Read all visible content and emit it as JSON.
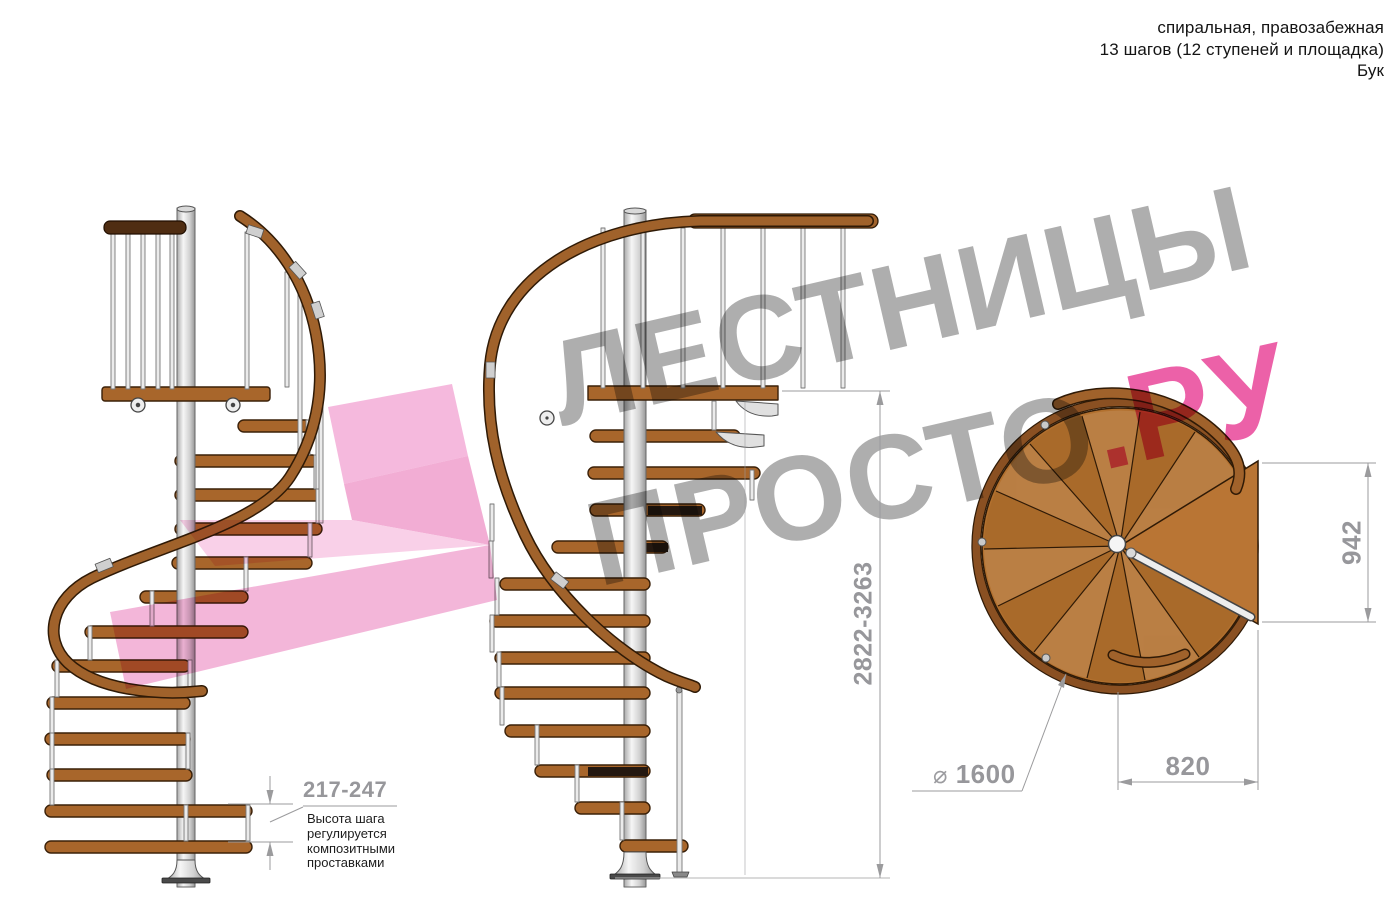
{
  "header": {
    "line1": "спиральная, правозабежная",
    "line2": "13 шагов (12 ступеней и площадка)",
    "line3": "Бук"
  },
  "watermark": {
    "line1": "ЛЕСТНИЦЫ",
    "line2_gray": "ПРОСТО",
    "line2_pink": ".РУ"
  },
  "dimensions": {
    "total_height": "2822-3263",
    "landing_length": "942",
    "landing_width": "820",
    "diameter_symbol": "⌀",
    "diameter_value": "1600",
    "step_height": "217-247"
  },
  "note": {
    "line1": "Высота шага",
    "line2": "регулируется",
    "line3": "композитными",
    "line4": "проставками"
  },
  "colors": {
    "wood": "#a0622b",
    "wood_dark": "#4f2d12",
    "steel": "#e8e8e8",
    "dimension_gray": "#97979b",
    "watermark_gray": "#9a9a9a",
    "watermark_pink": "#ec4f9b",
    "arrow_pink": "#f2a8d4"
  }
}
